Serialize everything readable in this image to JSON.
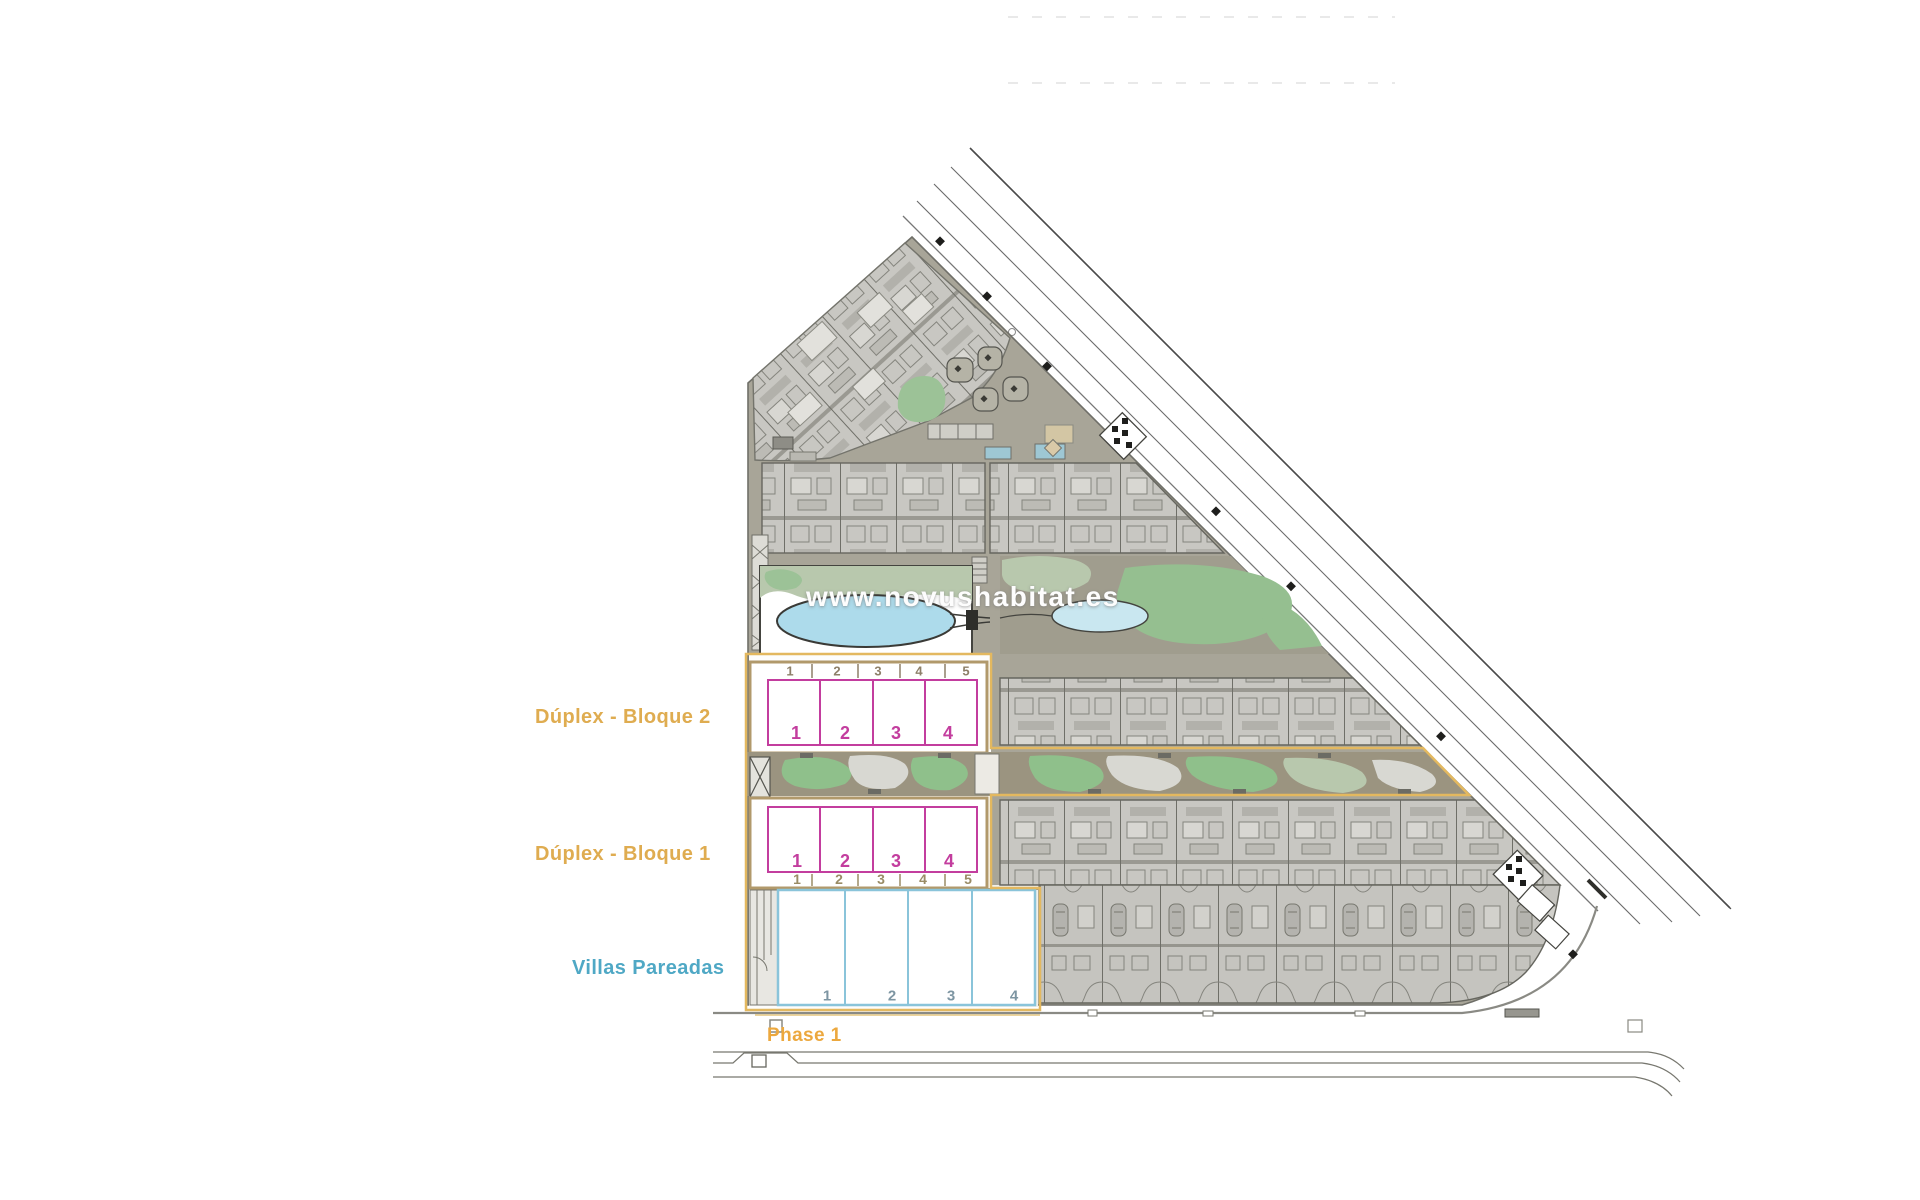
{
  "watermark": "www.novushabitat.es",
  "labels": {
    "duplex_block2": "Dúplex - Bloque 2",
    "duplex_block1": "Dúplex - Bloque 1",
    "villas": "Villas Pareadas",
    "phase": "Phase 1"
  },
  "blocks": {
    "duplex2": {
      "top_numbers": [
        "1",
        "2",
        "3",
        "4",
        "5"
      ],
      "units": [
        "1",
        "2",
        "3",
        "4"
      ]
    },
    "duplex1": {
      "units": [
        "1",
        "2",
        "3",
        "4"
      ],
      "bottom_numbers": [
        "1",
        "2",
        "3",
        "4",
        "5"
      ]
    },
    "villas": {
      "units": [
        "1",
        "2",
        "3",
        "4"
      ]
    }
  },
  "colors": {
    "label_gold": "#DFAC50",
    "label_teal": "#4FA8C5",
    "phase_orange": "#E3B85F",
    "unit_magenta": "#C33D9E",
    "villa_blue": "#8AC4DA",
    "block_border_tan": "#B1996B",
    "pool_blue": "#ADDBEB",
    "lawn_green": "#92C28C",
    "site_taupe": "#A8A598"
  }
}
